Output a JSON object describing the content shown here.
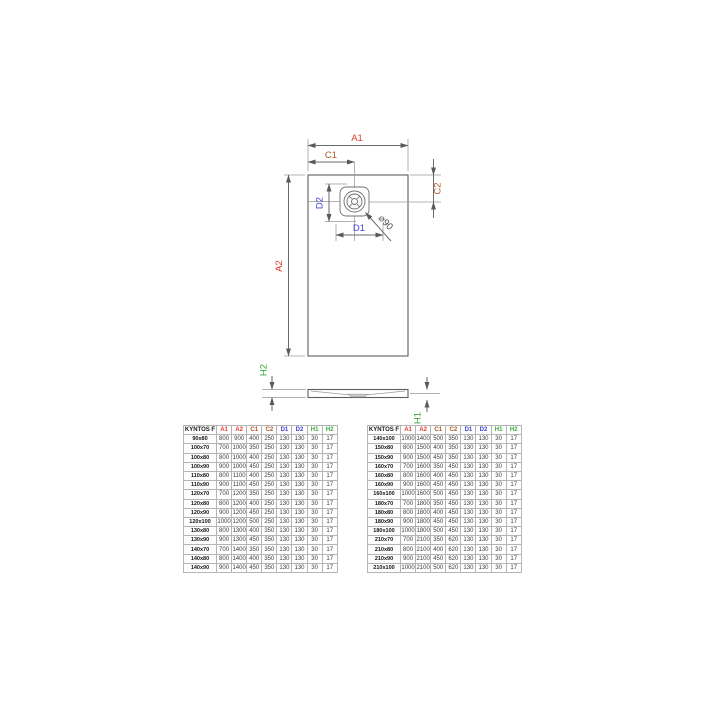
{
  "drawing": {
    "labels": {
      "a1": "A1",
      "a2": "A2",
      "c1": "C1",
      "c2": "C2",
      "d1": "D1",
      "d2": "D2",
      "h1": "H1",
      "h2": "H2",
      "diameter": "⌀90"
    },
    "colors": {
      "a": "#e23b2e",
      "c": "#b05a28",
      "d": "#4242d2",
      "h": "#3aa83a"
    }
  },
  "tables": {
    "columns": [
      "KYNTOS F",
      "A1",
      "A2",
      "C1",
      "C2",
      "D1",
      "D2",
      "H1",
      "H2"
    ],
    "header_colors": [
      "#1a1a1a",
      "#e23b2e",
      "#e23b2e",
      "#b05a28",
      "#b05a28",
      "#4242d2",
      "#4242d2",
      "#3aa83a",
      "#3aa83a"
    ],
    "left_rows": [
      [
        "90x80",
        "800",
        "900",
        "400",
        "250",
        "130",
        "130",
        "30",
        "17"
      ],
      [
        "100x70",
        "700",
        "1000",
        "350",
        "250",
        "130",
        "130",
        "30",
        "17"
      ],
      [
        "100x80",
        "800",
        "1000",
        "400",
        "250",
        "130",
        "130",
        "30",
        "17"
      ],
      [
        "100x90",
        "900",
        "1000",
        "450",
        "250",
        "130",
        "130",
        "30",
        "17"
      ],
      [
        "110x80",
        "800",
        "1100",
        "400",
        "250",
        "130",
        "130",
        "30",
        "17"
      ],
      [
        "110x90",
        "900",
        "1100",
        "450",
        "250",
        "130",
        "130",
        "30",
        "17"
      ],
      [
        "120x70",
        "700",
        "1200",
        "350",
        "250",
        "130",
        "130",
        "30",
        "17"
      ],
      [
        "120x80",
        "800",
        "1200",
        "400",
        "250",
        "130",
        "130",
        "30",
        "17"
      ],
      [
        "120x90",
        "900",
        "1200",
        "450",
        "250",
        "130",
        "130",
        "30",
        "17"
      ],
      [
        "120x100",
        "1000",
        "1200",
        "500",
        "250",
        "130",
        "130",
        "30",
        "17"
      ],
      [
        "130x80",
        "800",
        "1300",
        "400",
        "350",
        "130",
        "130",
        "30",
        "17"
      ],
      [
        "130x90",
        "900",
        "1300",
        "450",
        "350",
        "130",
        "130",
        "30",
        "17"
      ],
      [
        "140x70",
        "700",
        "1400",
        "350",
        "350",
        "130",
        "130",
        "30",
        "17"
      ],
      [
        "140x80",
        "800",
        "1400",
        "400",
        "350",
        "130",
        "130",
        "30",
        "17"
      ],
      [
        "140x90",
        "900",
        "1400",
        "450",
        "350",
        "130",
        "130",
        "30",
        "17"
      ]
    ],
    "right_rows": [
      [
        "140x100",
        "1000",
        "1400",
        "500",
        "350",
        "130",
        "130",
        "30",
        "17"
      ],
      [
        "150x80",
        "800",
        "1500",
        "400",
        "350",
        "130",
        "130",
        "30",
        "17"
      ],
      [
        "150x90",
        "900",
        "1500",
        "450",
        "350",
        "130",
        "130",
        "30",
        "17"
      ],
      [
        "160x70",
        "700",
        "1600",
        "350",
        "450",
        "130",
        "130",
        "30",
        "17"
      ],
      [
        "160x80",
        "800",
        "1600",
        "400",
        "450",
        "130",
        "130",
        "30",
        "17"
      ],
      [
        "160x90",
        "900",
        "1600",
        "450",
        "450",
        "130",
        "130",
        "30",
        "17"
      ],
      [
        "160x100",
        "1000",
        "1600",
        "500",
        "450",
        "130",
        "130",
        "30",
        "17"
      ],
      [
        "180x70",
        "700",
        "1800",
        "350",
        "450",
        "130",
        "130",
        "30",
        "17"
      ],
      [
        "180x80",
        "800",
        "1800",
        "400",
        "450",
        "130",
        "130",
        "30",
        "17"
      ],
      [
        "180x90",
        "900",
        "1800",
        "450",
        "450",
        "130",
        "130",
        "30",
        "17"
      ],
      [
        "180x100",
        "1000",
        "1800",
        "500",
        "450",
        "130",
        "130",
        "30",
        "17"
      ],
      [
        "210x70",
        "700",
        "2100",
        "350",
        "620",
        "130",
        "130",
        "30",
        "17"
      ],
      [
        "210x80",
        "800",
        "2100",
        "400",
        "620",
        "130",
        "130",
        "30",
        "17"
      ],
      [
        "210x90",
        "900",
        "2100",
        "450",
        "620",
        "130",
        "130",
        "30",
        "17"
      ],
      [
        "210x100",
        "1000",
        "2100",
        "500",
        "620",
        "130",
        "130",
        "30",
        "17"
      ]
    ]
  }
}
